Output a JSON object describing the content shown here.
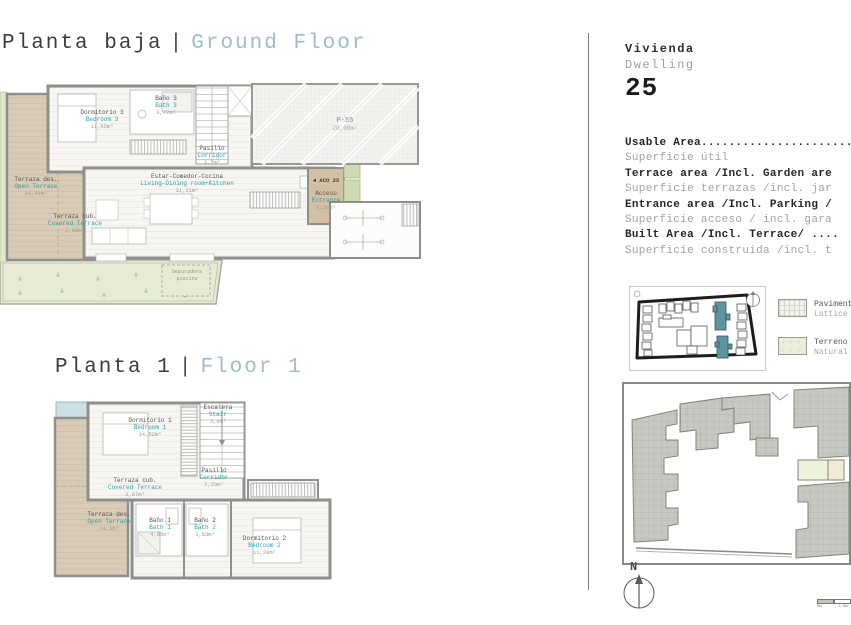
{
  "titles": {
    "ground": {
      "es": "Planta baja",
      "sep": "|",
      "en": "Ground Floor"
    },
    "first": {
      "es": "Planta 1",
      "sep": "|",
      "en": "Floor 1"
    }
  },
  "dwelling": {
    "es": "Vivienda",
    "en": "Dwelling",
    "number": "25"
  },
  "area_table": {
    "rows": [
      {
        "en": "Usable Area.......................",
        "es": "Superficie útil"
      },
      {
        "en": "Terrace area /Incl. Garden are",
        "es": "Superficie terrazas /incl. jar"
      },
      {
        "en": "Entrance area /Incl. Parking /",
        "es": "Superficie acceso / incl. gara"
      },
      {
        "en": "Built Area /Incl. Terrace/ ....",
        "es": "Superficie construida /incl. t"
      }
    ]
  },
  "legend": {
    "items": [
      {
        "es": "Pavimento",
        "en": "Lattice"
      },
      {
        "es": "Terreno",
        "en": "Natural"
      }
    ]
  },
  "ground_floor": {
    "rooms": [
      {
        "es": "Dormitorio 3",
        "en": "Bedroom 3",
        "area": "11,65m²"
      },
      {
        "es": "Baño 3",
        "en": "Bath 3",
        "area": "3,77m²"
      },
      {
        "es": "Pasillo",
        "en": "Corridor",
        "area": "3,7m²"
      },
      {
        "es": "Estar-Comedor-Cocina",
        "en": "Living-Dining room+Kitchen",
        "area": "31,21m²"
      },
      {
        "es": "Terraza des.",
        "en": "Open Terrace",
        "area": "14,44m²"
      },
      {
        "es": "Terraza cub.",
        "en": "Covered Terrace",
        "area": "2,69m²"
      },
      {
        "es": "Acceso",
        "en": "Entrance",
        "area": "6,26m²"
      }
    ],
    "parking": {
      "name": "P-55",
      "area": "20,08m²"
    },
    "door_tag": "◄ ACO 25",
    "pool_note": {
      "line1": "Depuradora",
      "line2": "piscina"
    }
  },
  "floor1": {
    "rooms": [
      {
        "es": "Dormitorio 1",
        "en": "Bedroom 1",
        "area": "14,52m²"
      },
      {
        "es": "Escalera",
        "en": "Stair",
        "area": "3,6m²"
      },
      {
        "es": "Pasillo",
        "en": "Corridor",
        "area": "2,23m²"
      },
      {
        "es": "Terraza cub.",
        "en": "Covered Terrace",
        "area": "3,67m²"
      },
      {
        "es": "Terraza des.",
        "en": "Open Terrace",
        "area": "14,5m²"
      },
      {
        "es": "Baño 1",
        "en": "Bath 1",
        "area": "4,05m²"
      },
      {
        "es": "Baño 2",
        "en": "Bath 2",
        "area": "3,53m²"
      },
      {
        "es": "Dormitorio 2",
        "en": "Bedroom 2",
        "area": "11,28m²"
      }
    ]
  },
  "compass": {
    "label": "N"
  },
  "scalebar": {
    "labels": [
      "0m",
      "2.5m",
      "5m"
    ]
  }
}
